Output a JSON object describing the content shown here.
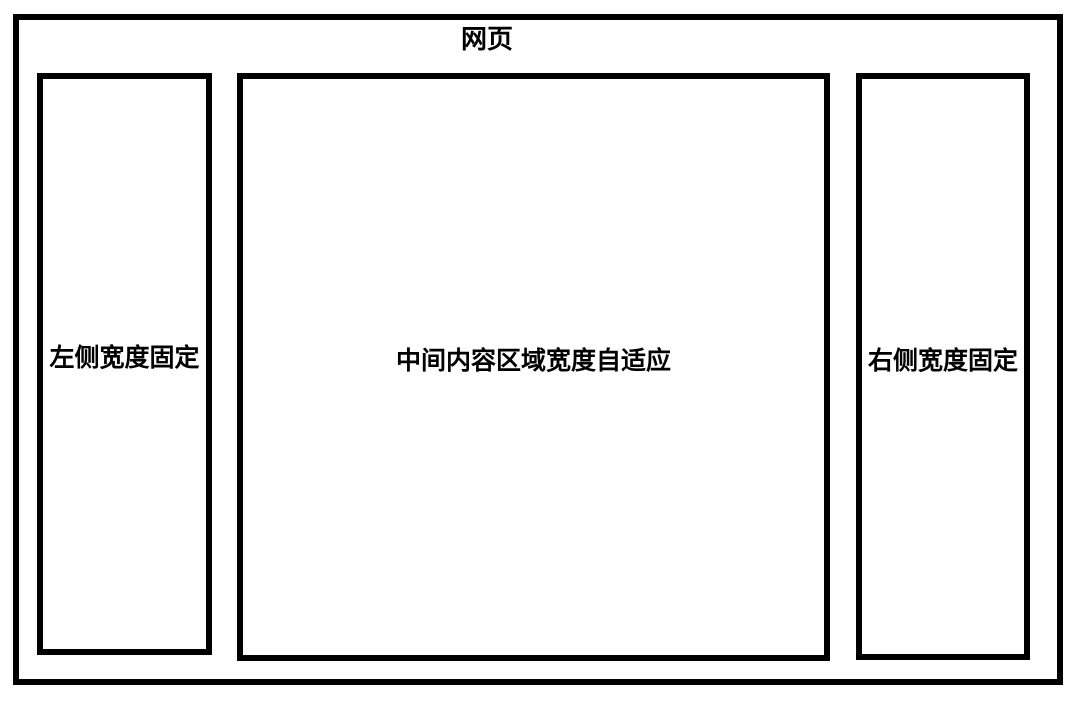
{
  "diagram": {
    "title": "网页",
    "panels": {
      "left": {
        "label": "左侧宽度固定"
      },
      "center": {
        "label": "中间内容区域宽度自适应"
      },
      "right": {
        "label": "右侧宽度固定"
      }
    }
  },
  "colors": {
    "border": "#000000",
    "background": "#ffffff",
    "text": "#000000"
  }
}
